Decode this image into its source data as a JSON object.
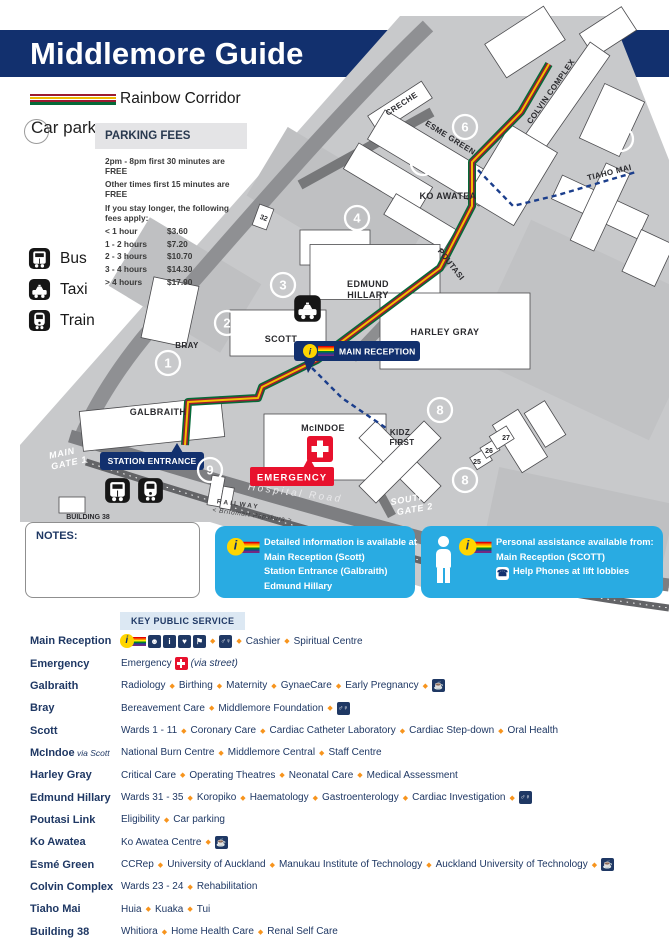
{
  "header": {
    "title": "Middlemore Guide"
  },
  "legend": {
    "rainbow_corridor_label": "Rainbow Corridor",
    "car_park_label": "Car park",
    "transport": [
      {
        "icon": "bus-icon",
        "label": "Bus"
      },
      {
        "icon": "taxi-icon",
        "label": "Taxi"
      },
      {
        "icon": "train-icon",
        "label": "Train"
      }
    ]
  },
  "parking": {
    "title": "PARKING FEES",
    "notes": [
      "2pm - 8pm first 30 minutes are FREE",
      "Other times first 15 minutes are FREE",
      "If you stay longer, the following fees apply:"
    ],
    "fees": [
      {
        "duration": "< 1 hour",
        "price": "$3.60"
      },
      {
        "duration": "1 - 2 hours",
        "price": "$7.20"
      },
      {
        "duration": "2 - 3 hours",
        "price": "$10.70"
      },
      {
        "duration": "3 - 4 hours",
        "price": "$14.30"
      },
      {
        "duration": "> 4 hours",
        "price": "$17.90"
      }
    ]
  },
  "map": {
    "labels": {
      "creche": "CRECHE",
      "esme_green": "ESME GREEN",
      "colvin_complex": "COLVIN COMPLEX",
      "ko_awatea": "KO AWATEA",
      "tiaho_mai": "TIAHO MAI",
      "poutasi": "POUTASI",
      "edmund_1": "EDMUND",
      "edmund_2": "HILLARY",
      "harley_gray": "HARLEY GRAY",
      "scott": "SCOTT",
      "bray": "BRAY",
      "galbraith": "GALBRAITH",
      "mcindoe": "McINDOE",
      "kidz_1": "KIDZ",
      "kidz_2": "FIRST",
      "main_gate_1": "MAIN",
      "main_gate_2": "GATE 1",
      "south_gate_1": "SOUTH",
      "south_gate_2": "GATE 2",
      "hospital_road": "Hospital Road",
      "railway": "RAILWAY",
      "railway_sub": "< Britomart  Papakura >",
      "building_38": "BUILDING 38",
      "n32": "32",
      "n25": "25",
      "n26": "26",
      "n27": "27"
    },
    "badges": {
      "main_reception": "MAIN RECEPTION",
      "station_entrance": "STATION ENTRANCE",
      "emergency": "EMERGENCY"
    },
    "circles": {
      "c1": "1",
      "c2": "2",
      "c3": "3",
      "c4": "4",
      "c5": "5",
      "c6": "6",
      "c7": "7",
      "c8": "8",
      "c9": "9"
    }
  },
  "notes_box": {
    "label": "NOTES:"
  },
  "info_boxes": {
    "detailed": {
      "lines": [
        "Detailed  information is available at",
        "Main Reception (Scott)",
        "Station Entrance (Galbraith)",
        "Edmund Hillary"
      ]
    },
    "personal": {
      "title": "Personal assistance available from:",
      "line1": "Main Reception (SCOTT)",
      "line2": "Help Phones at lift lobbies"
    }
  },
  "services": {
    "header": "KEY PUBLIC SERVICE",
    "rows": [
      {
        "label": "Main Reception",
        "note": "",
        "tokens": [
          "icon:irainbow",
          "icon:desk",
          "icon:info",
          "icon:care",
          "icon:shop",
          "dia",
          "icon:toilets",
          "dia",
          "Cashier",
          "dia",
          "Spiritual Centre"
        ]
      },
      {
        "label": "Emergency",
        "note": "",
        "tokens": [
          "Emergency",
          "icon:redcross",
          "it:(via street)"
        ]
      },
      {
        "label": "Galbraith",
        "note": "",
        "tokens": [
          "Radiology",
          "dia",
          "Birthing",
          "dia",
          "Maternity",
          "dia",
          "GynaeCare",
          "dia",
          "Early Pregnancy",
          "dia",
          "icon:cafe"
        ]
      },
      {
        "label": "Bray",
        "note": "",
        "tokens": [
          "Bereavement Care",
          "dia",
          "Middlemore Foundation",
          "dia",
          "icon:toilets"
        ]
      },
      {
        "label": "Scott",
        "note": "",
        "tokens": [
          "Wards 1 - 11",
          "dia",
          "Coronary Care",
          "dia",
          "Cardiac Catheter Laboratory",
          "dia",
          "Cardiac Step-down",
          "dia",
          "Oral Health"
        ]
      },
      {
        "label": "McIndoe",
        "note": "via Scott",
        "tokens": [
          "National Burn Centre",
          "dia",
          "Middlemore Central",
          "dia",
          "Staff Centre"
        ]
      },
      {
        "label": "Harley Gray",
        "note": "",
        "tokens": [
          "Critical Care",
          "dia",
          "Operating Theatres",
          "dia",
          "Neonatal Care",
          "dia",
          "Medical Assessment"
        ]
      },
      {
        "label": "Edmund Hillary",
        "note": "",
        "tokens": [
          "Wards 31 - 35",
          "dia",
          "Koropiko",
          "dia",
          "Haematology",
          "dia",
          "Gastroenterology",
          "dia",
          "Cardiac Investigation",
          "dia",
          "icon:toilets"
        ]
      },
      {
        "label": "Poutasi Link",
        "note": "",
        "tokens": [
          "Eligibility",
          "dia",
          "Car parking"
        ]
      },
      {
        "label": "Ko Awatea",
        "note": "",
        "tokens": [
          "Ko Awatea Centre",
          "dia",
          "icon:cafe"
        ]
      },
      {
        "label": "Esmé Green",
        "note": "",
        "tokens": [
          "CCRep",
          "dia",
          "University of Auckland",
          "dia",
          "Manukau Institute of Technology",
          "dia",
          "Auckland University of Technology",
          "dia",
          "icon:cafe"
        ]
      },
      {
        "label": "Colvin Complex",
        "note": "",
        "tokens": [
          "Wards 23 - 24",
          "dia",
          "Rehabilitation"
        ]
      },
      {
        "label": "Tiaho Mai",
        "note": "",
        "tokens": [
          "Huia",
          "dia",
          "Kuaka",
          "dia",
          "Tui"
        ]
      },
      {
        "label": "Building 38",
        "note": "",
        "tokens": [
          "Whitiora",
          "dia",
          "Home Health Care",
          "dia",
          "Renal Self Care"
        ]
      }
    ]
  },
  "colors": {
    "navy": "#12306E",
    "text_navy": "#1F3864",
    "cyan_box": "#29ABE2",
    "emergency_red": "#E8112D",
    "diamond_orange": "#F7941D",
    "corridor_green": "#046A38",
    "corridor_maroon": "#9B1B30",
    "corridor_yellow": "#F2C100",
    "info_yellow": "#FFD500",
    "map_gray": "#C8C9CB"
  }
}
